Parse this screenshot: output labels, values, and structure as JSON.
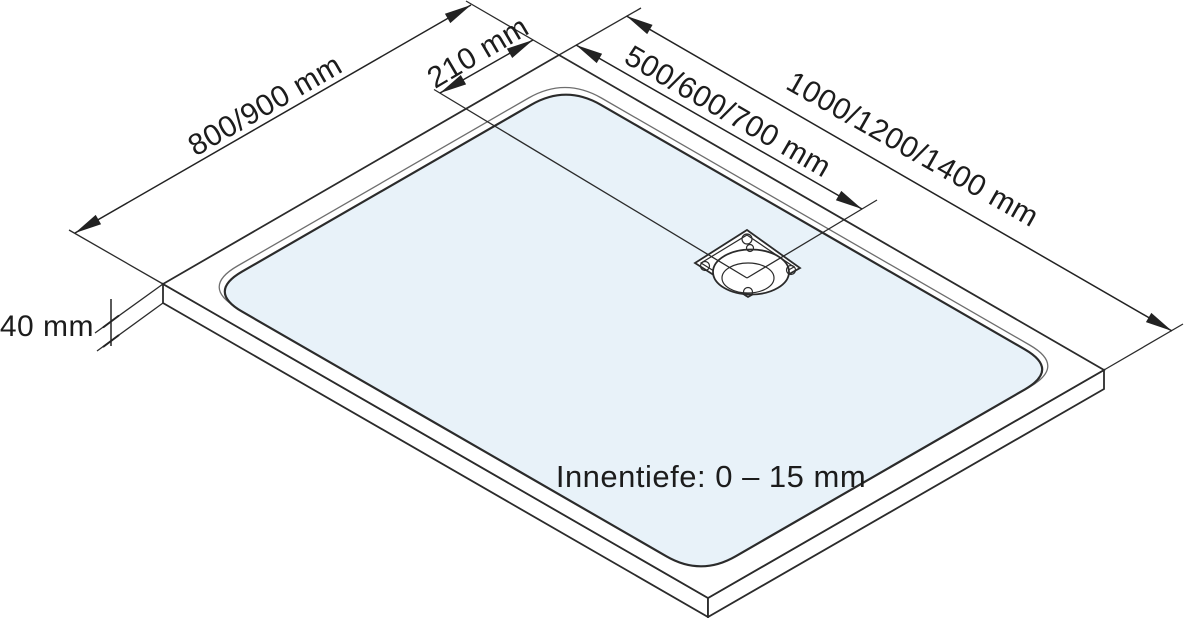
{
  "labels": {
    "depth_dim": "800/900 mm",
    "drain_offset_dim": "210 mm",
    "drain_distance_dim": "500/600/700 mm",
    "length_dim": "1000/1200/1400 mm",
    "height_dim": "40 mm",
    "inner_depth_note": "Innentiefe: 0 – 15 mm"
  },
  "colors": {
    "line": "#2b2b2b",
    "basin_fill": "#e8f2f9",
    "background": "#ffffff"
  }
}
